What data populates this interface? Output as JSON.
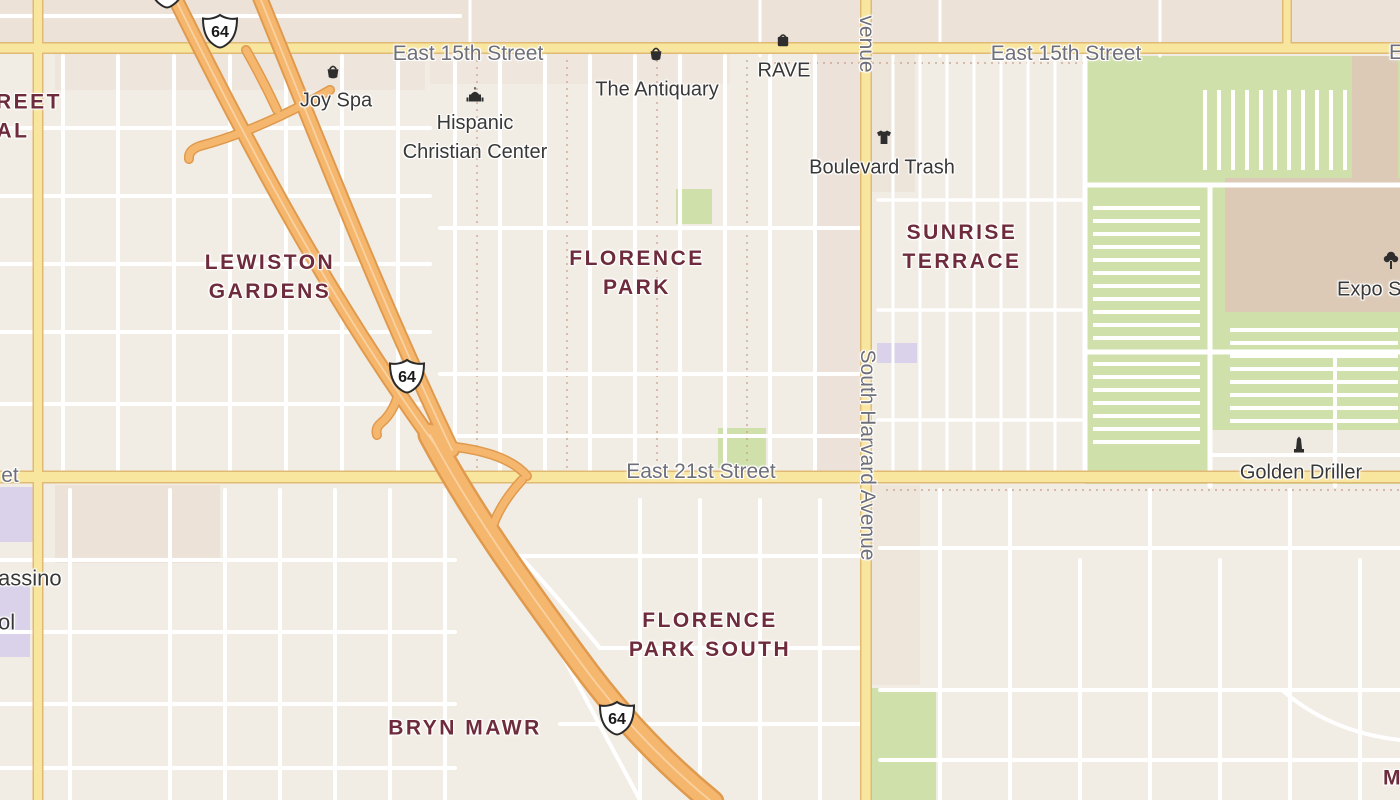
{
  "map_colors": {
    "land": "#f2ede4",
    "block_tint": "#ece1d8",
    "minor_road": "#ffffff",
    "major_road_fill": "#f8e59e",
    "major_road_casing": "#e0ba74",
    "highway_fill": "#f5b76e",
    "highway_casing": "#e09a4e",
    "green_area": "#cfe0aa",
    "purple_area": "#d9d2ea",
    "building": "#dccab7",
    "neighborhood_text": "#6d2b3c",
    "street_text": "#6f6f79",
    "poi_text": "#383838"
  },
  "shield": {
    "number": "64"
  },
  "neighborhoods": {
    "lewiston_gardens": {
      "line1": "LEWISTON",
      "line2": "GARDENS"
    },
    "florence_park": {
      "line1": "FLORENCE",
      "line2": "PARK"
    },
    "sunrise_terrace": {
      "line1": "SUNRISE",
      "line2": "TERRACE"
    },
    "florence_park_south": {
      "line1": "FLORENCE",
      "line2": "PARK SOUTH"
    },
    "bryn_mawr": {
      "label": "BRYN MAWR"
    },
    "fragment_top_left_line1": "REET",
    "fragment_top_left_line2": "AL",
    "fragment_bottom_right": "M"
  },
  "streets": {
    "east_15th_left": "East 15th Street",
    "east_15th_right": "East 15th Street",
    "east_21st": "East 21st Street",
    "south_harvard": "South Harvard Avenue",
    "harvard_top_fragment": "venue",
    "fragment_left_edge": "et",
    "fragment_right_edge": "E"
  },
  "pois": {
    "joy_spa": "Joy Spa",
    "the_antiquary": "The Antiquary",
    "rave": "RAVE",
    "hispanic_christian_center": {
      "line1": "Hispanic",
      "line2": "Christian Center"
    },
    "boulevard_trash": "Boulevard Trash",
    "golden_driller": "Golden Driller",
    "expo_square": "Expo Sq",
    "pool_fragment_line1": "assino",
    "pool_fragment_line2": "ol"
  }
}
